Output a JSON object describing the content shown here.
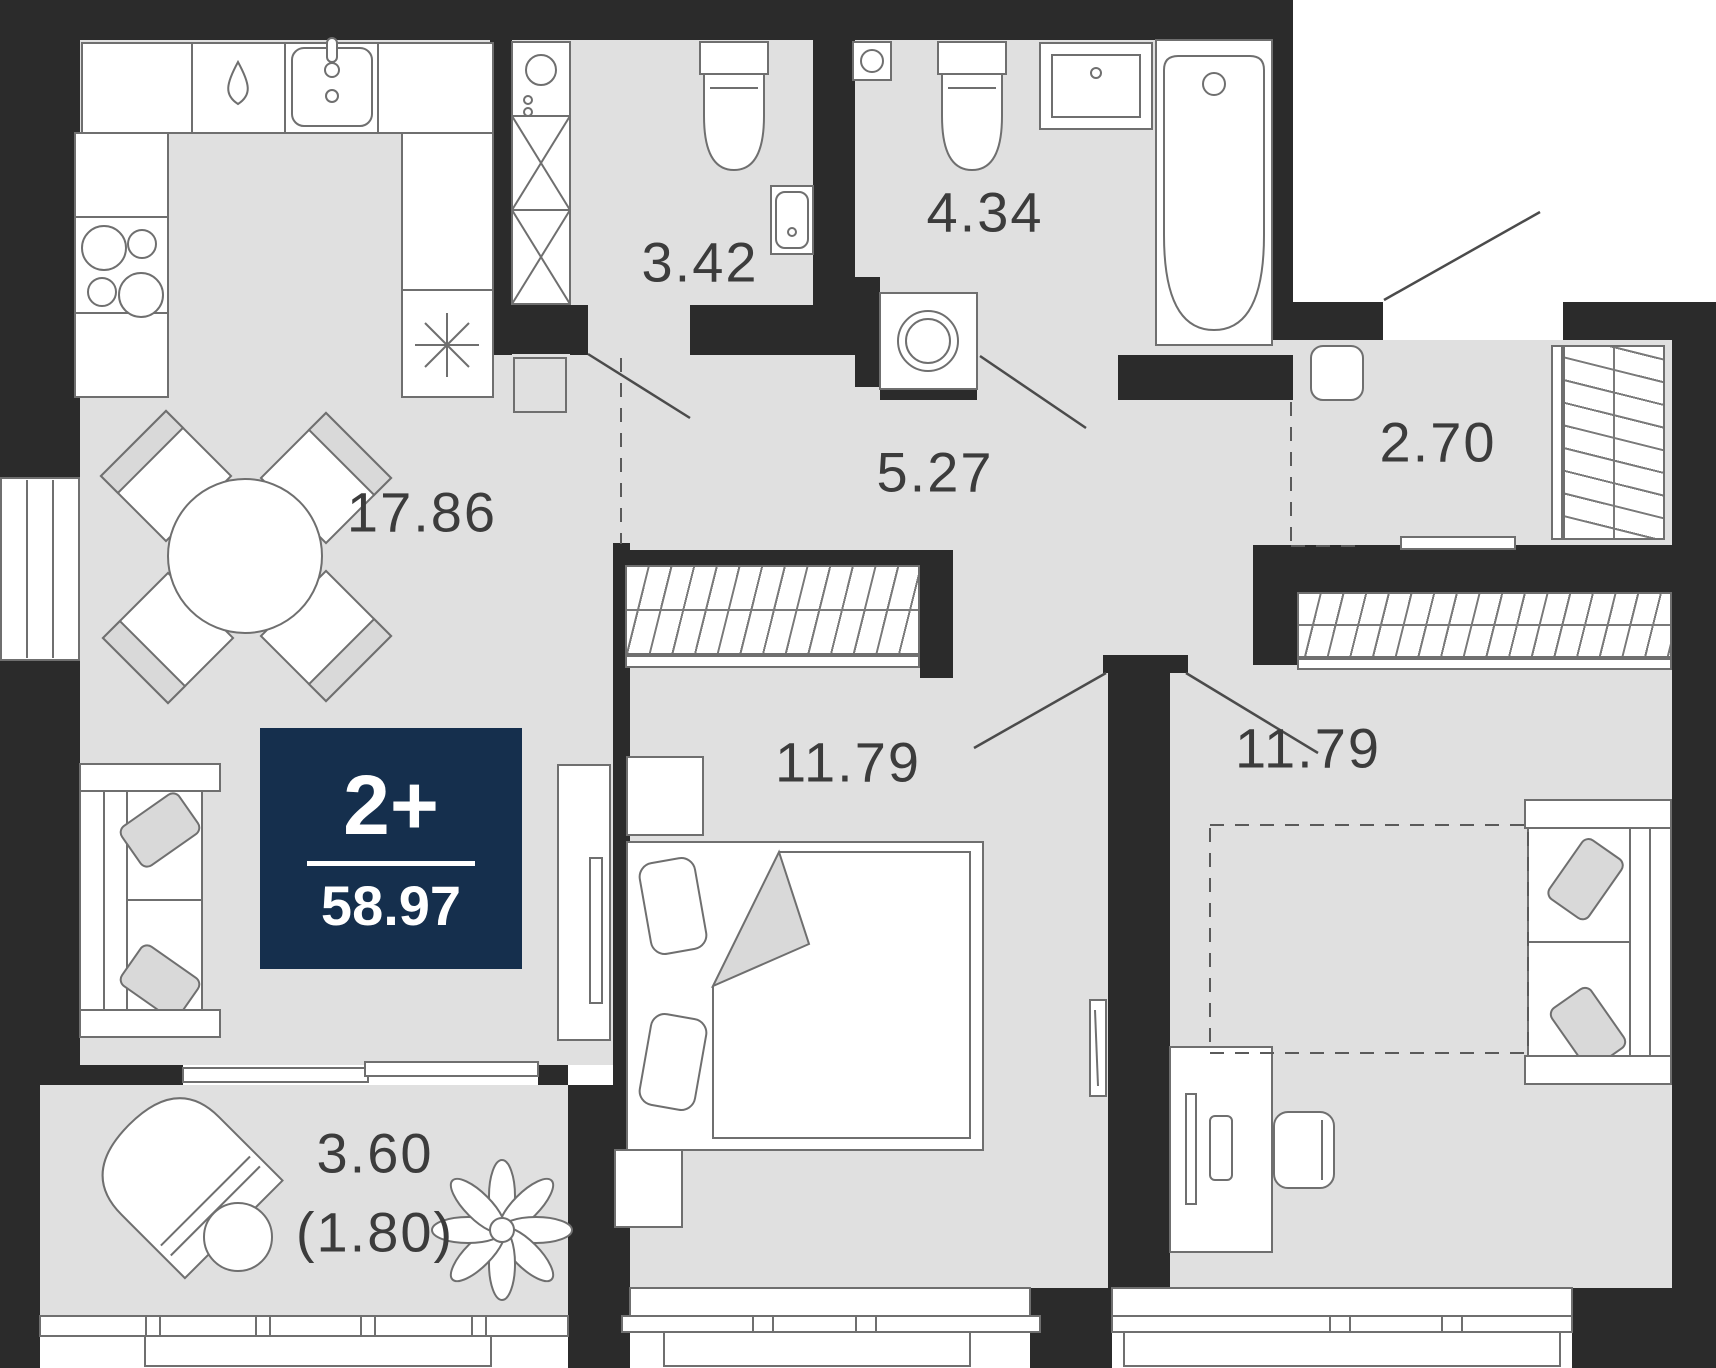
{
  "badge": {
    "rooms_label": "2+",
    "total_area": "58.97"
  },
  "rooms": {
    "living": {
      "name": "kitchen-living-room",
      "area": "17.86"
    },
    "bathroom_small": {
      "name": "wc",
      "area": "3.42"
    },
    "bathroom": {
      "name": "bathroom",
      "area": "4.34"
    },
    "hallway": {
      "name": "hallway",
      "area": "5.27"
    },
    "closet": {
      "name": "walk-in-closet",
      "area": "2.70"
    },
    "bedroom1": {
      "name": "bedroom-1",
      "area": "11.79"
    },
    "bedroom2": {
      "name": "bedroom-2",
      "area": "11.79"
    },
    "balcony": {
      "name": "balcony",
      "area": "3.60",
      "area_reduced": "(1.80)"
    }
  },
  "colors": {
    "wall": "#2b2b2b",
    "floor": "#e0e0e0",
    "accent_badge": "#152f4d",
    "furniture_line": "#6f6f6f",
    "label_text": "#3c3c3c"
  },
  "icons": [
    "kitchen-sink-icon",
    "dishwasher-drop-icon",
    "stove-icon",
    "snowflake-icon",
    "boiler-icon",
    "vent-shaft-icon",
    "toilet-icon",
    "washbasin-icon",
    "bathtub-icon",
    "washing-machine-icon",
    "wardrobe-icon",
    "dining-table-icon",
    "chair-icon",
    "sofa-icon",
    "tv-icon",
    "bed-icon",
    "nightstand-icon",
    "desk-icon",
    "desk-chair-icon",
    "lounge-chair-icon",
    "side-table-icon",
    "plant-icon",
    "door-swing-icon",
    "window-icon"
  ]
}
